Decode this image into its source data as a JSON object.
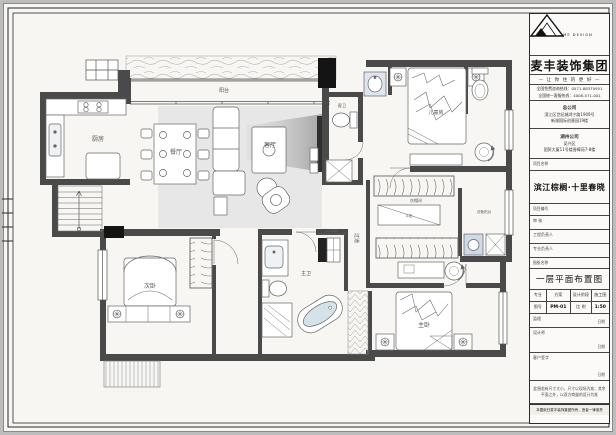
{
  "titleblock": {
    "logo_caption": "MY HOME DESIGN",
    "company": "麦丰装饰集团",
    "slogan": "— 让 你 住 的 更 好 —",
    "hotline1": "全国免费咨询热线：0571-88370951",
    "hotline2": "全国统一客服热线：4008-571-001",
    "hq_title": "总公司",
    "hq_addr1": "滨江区世纪城鸿宁路1909号",
    "hq_addr2": "新湖国际创意园19楼",
    "branch_title": "湖州公司",
    "branch_addr1": "吴兴区",
    "branch_addr2": "国贸大厦11号楼香樟苑7-8楼",
    "project_label": "项目名称",
    "project_name": "滨江棕榈·十里春晓",
    "project_no_label": "项目编号",
    "review_label": "审 核",
    "pm_label": "工程负责人",
    "lead_label": "专业负责人",
    "drawing_label": "图纸名称",
    "drawing_name": "一层平面布置图",
    "table": {
      "c1": "专业",
      "c2": "方案",
      "c3": "设计阶段",
      "c4": "施工图",
      "c5": "图号",
      "c6": "PM-01",
      "c7": "比 例",
      "c8": "1:50"
    },
    "supervisor_label": "监理",
    "designer_label": "设计师",
    "client_label": "客户签字",
    "date_label": "日期",
    "note": "此图若有尺寸大小，尺寸以现场为准；其余平面之外，以双方商量的设计为准",
    "copyright": "本图纸归麦丰装饰集团所有，违者一律追责"
  },
  "plan": {
    "labels": {
      "balcony": "阳台",
      "kitchen": "厨房",
      "dining": "餐厅",
      "living": "客厅",
      "guest_bath": "客卫",
      "cabinet": "斗柜",
      "closet": "衣帽间",
      "equipment": "设备阳台",
      "kids": "儿童房",
      "master": "主卧",
      "second": "次卧",
      "master_bath": "主卫",
      "corridor": "过道",
      "elevation": "±0.000"
    },
    "scale": "1:50"
  },
  "colors": {
    "wall": "#4a4a4a",
    "column": "#141414",
    "rug": "#e7e7e7",
    "tub_water": "#d6e2ea",
    "appliance": "#cfdae8"
  }
}
